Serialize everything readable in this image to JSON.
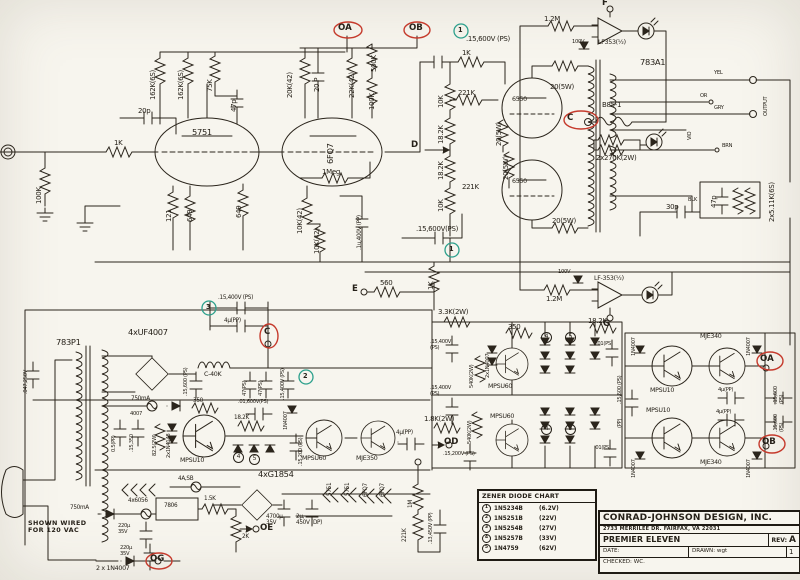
{
  "colors": {
    "ink": "#262119",
    "red": "#c53a2c",
    "green": "#2ca08c",
    "paper": "#f7f5ee"
  },
  "tl": {
    "c20p": "20p",
    "r162a": "162K(6S)",
    "r162b": "162K(6S)",
    "r75k": "75K",
    "c47p": "47p",
    "v1": "5751",
    "r1k": "1K",
    "r100k": "100K",
    "r121": "121",
    "r649a": "649",
    "r649b": "649",
    "gA": "OA",
    "gB": "OB"
  },
  "drv": {
    "r20k": "20K(42)",
    "c20p": "20 P",
    "r22k": "22K(42)",
    "r500k": "500K",
    "r100k": "100K",
    "v2": "6FQ7",
    "r1meg": "1Meg",
    "r10ka": "10K(42)",
    "r10kb": "10K(42)",
    "c1u": ".1u,400V (PP)"
  },
  "out": {
    "ref1a": "1",
    "ccta": ".15,600V (PS)",
    "r1k": "1K",
    "r221a": "221K",
    "r10a": "10K",
    "r18a": "18.2K",
    "r18b": "18.2K",
    "r10b": "10K",
    "tD": "D",
    "v3": "6550",
    "v4": "6550",
    "r221b": "221K",
    "r20a": "20(5W)",
    "r20b": "20(5W)",
    "r20c": "20(5W)",
    "r20d": "20(5W)",
    "cctb": ".15,600V(PS)",
    "ref1b": "1",
    "r560": "560",
    "tE": "E",
    "r1kfb": "1K"
  },
  "servo": {
    "r12a": "1.2M",
    "d100a": "100V",
    "u1": "LF353(½)",
    "tF": "F",
    "r12b": "1.2M",
    "d100b": "100V",
    "u2": "LF-353(½)",
    "tG": "G",
    "lamp": "B85-1",
    "tC": "C",
    "r270": "2x270K(2W)"
  },
  "oxf": {
    "name": "783A1",
    "yel": "YEL",
    "or": "OR",
    "gry": "GRY",
    "vio": "VIO",
    "brn": "BRN",
    "blk": "BLK",
    "outp": "OUTPUT",
    "c47p": "47p",
    "c30p": "30p",
    "r511": "2x5.11K(6S)"
  },
  "bias": {
    "r33k": "3.3K(2W)",
    "ca": ".15,400V\n(PS)",
    "d2x": "2x1N4007",
    "r350": "350",
    "r540a": "540K(2W)",
    "r540b": "540K(2W)",
    "q1": "MPSU60",
    "q2": "MPSU60",
    "r18k": "18.2K",
    "c01a": ".01(PS)",
    "r18b": "1.8K(2W)",
    "cb": ".15,400V\n(PS)",
    "cc": ".15,200V (PS)",
    "c01b": ".01(PS)",
    "z4a": "4",
    "z5a": "5",
    "z4b": "4",
    "z5b": "5"
  },
  "rt": {
    "d1": "1N4007",
    "d2": "1N4007",
    "d3": "1N4007",
    "d4": "1N4007",
    "q1": "MPSU10",
    "q2": "MPSU10",
    "q3": "MJE340",
    "q4": "MJE340",
    "c4a": "4μ(PP)",
    "c4b": "4μ(PP)",
    "ca": ".15,600 (PS)",
    "cd": "(PP)",
    "cb": ".15,600\n(PS)",
    "cc": ".15,600\n(PS)",
    "tA": "OA",
    "tB": "OB"
  },
  "psu": {
    "xf": "783P1",
    "br1": "4xUF4007",
    "c047": ".047,250V",
    "c156": ".15,600 (PS)",
    "choke": "C-40K",
    "ref3": "3",
    "c154a": ".15,400V (PS)",
    "c4u": "4μ(PP)",
    "tC": "C",
    "c47a": "47(PS)",
    "c47b": "47(PS)",
    "c154b": ".15,400V (PS)",
    "ref2": "2",
    "fus1": "750mA",
    "d4007": "4007",
    "c05": "0.5(PP)",
    "c1535": ".15,350",
    "r825": "82.5(2W)",
    "d4148": "2x1N4148",
    "q1": "MPSU10",
    "r350": "350",
    "c016": ".01,600V(PS)",
    "r18k": "18.2K",
    "z4": "4",
    "z5": "5",
    "d40v": "1N4007",
    "c152": ".15,200 (PS)",
    "q2": "MPSU60",
    "q3": "MJE350",
    "c4ud": "4μ(PP)",
    "tD": "OD",
    "br2": "4xG1854",
    "fus2": "4A,SB",
    "w6": "4x6056",
    "fus3": "750mA",
    "note": "SHOWN WIRED\nFOR 120 VAC",
    "reg": "7806",
    "r15k": "1.5K",
    "r2k": "2K",
    "c220a": "220μ\n35V",
    "c220b": "220μ\n35V",
    "tE": "OE",
    "tG": "OG",
    "d2x": "2 x 1N4007",
    "c47h": "4700μ\n35V",
    "c2u": "2μ,\n450V (DP)",
    "h1": "5751",
    "h2": "5751",
    "h3": "6FQ7",
    "h4": "6FQ7",
    "r1m": "1M",
    "r221k": "221K",
    "c1345": ".13,450V (PP)"
  },
  "zchart": {
    "title": "ZENER DIODE CHART",
    "rows": [
      {
        "ref": "1",
        "part": "1N5234B",
        "v": "(6.2V)"
      },
      {
        "ref": "2",
        "part": "1N5251B",
        "v": "(22V)"
      },
      {
        "ref": "3",
        "part": "1N5254B",
        "v": "(27V)"
      },
      {
        "ref": "4",
        "part": "1N5257B",
        "v": "(33V)"
      },
      {
        "ref": "5",
        "part": "1N4759",
        "v": "(62V)"
      }
    ]
  },
  "tb": {
    "company": "CONRAD-JOHNSON DESIGN, INC.",
    "address": "2733 MERRILEE DR. FAIRFAX, VA 22031",
    "model": "PREMIER ELEVEN",
    "rev_label": "REV:",
    "rev": "A",
    "date_label": "DATE:",
    "drawn_label": "DRAWN:",
    "drawn": "wgt",
    "checked_label": "CHECKED:",
    "checked": "WC.",
    "sheet": "1"
  }
}
